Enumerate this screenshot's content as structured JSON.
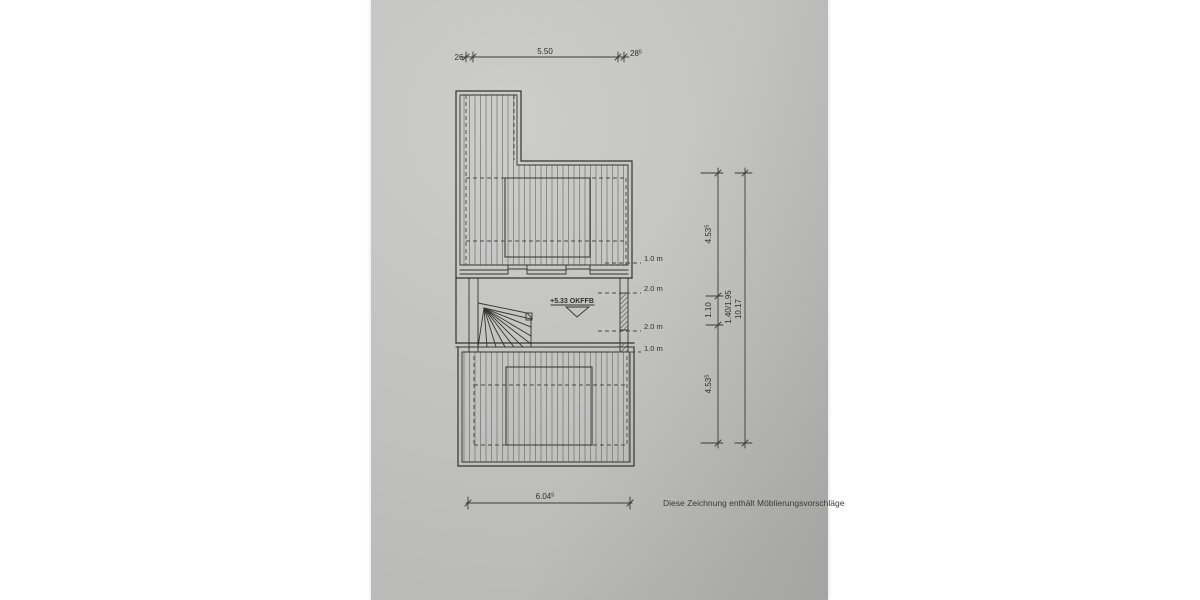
{
  "colors": {
    "paper": "#c7c7c5",
    "paper_edge": "#b1b1af",
    "ink": "#333333",
    "hatch": "#707072",
    "text": "#2f2f2f"
  },
  "note": {
    "text": "Diese Zeichnung enthält Möblierungsvorschläge"
  },
  "level_marker": {
    "label": "+5.33 OKFFB"
  },
  "height_lines": [
    {
      "label": "1.0 m"
    },
    {
      "label": "2.0 m"
    },
    {
      "label": "2.0 m"
    },
    {
      "label": "1.0 m"
    }
  ],
  "dimensions": {
    "top": {
      "left_wall": "26",
      "span": "5.50",
      "right_wall": "28",
      "right_wall_sup": "5"
    },
    "bottom": {
      "span": "6.04",
      "span_sup": "5"
    },
    "right": {
      "upper_room": "4.53",
      "upper_room_sup": "5",
      "landing": "1.10",
      "opening": "1.40/1.95",
      "lower_room": "4.53",
      "lower_room_sup": "5",
      "total": "10.17"
    }
  }
}
